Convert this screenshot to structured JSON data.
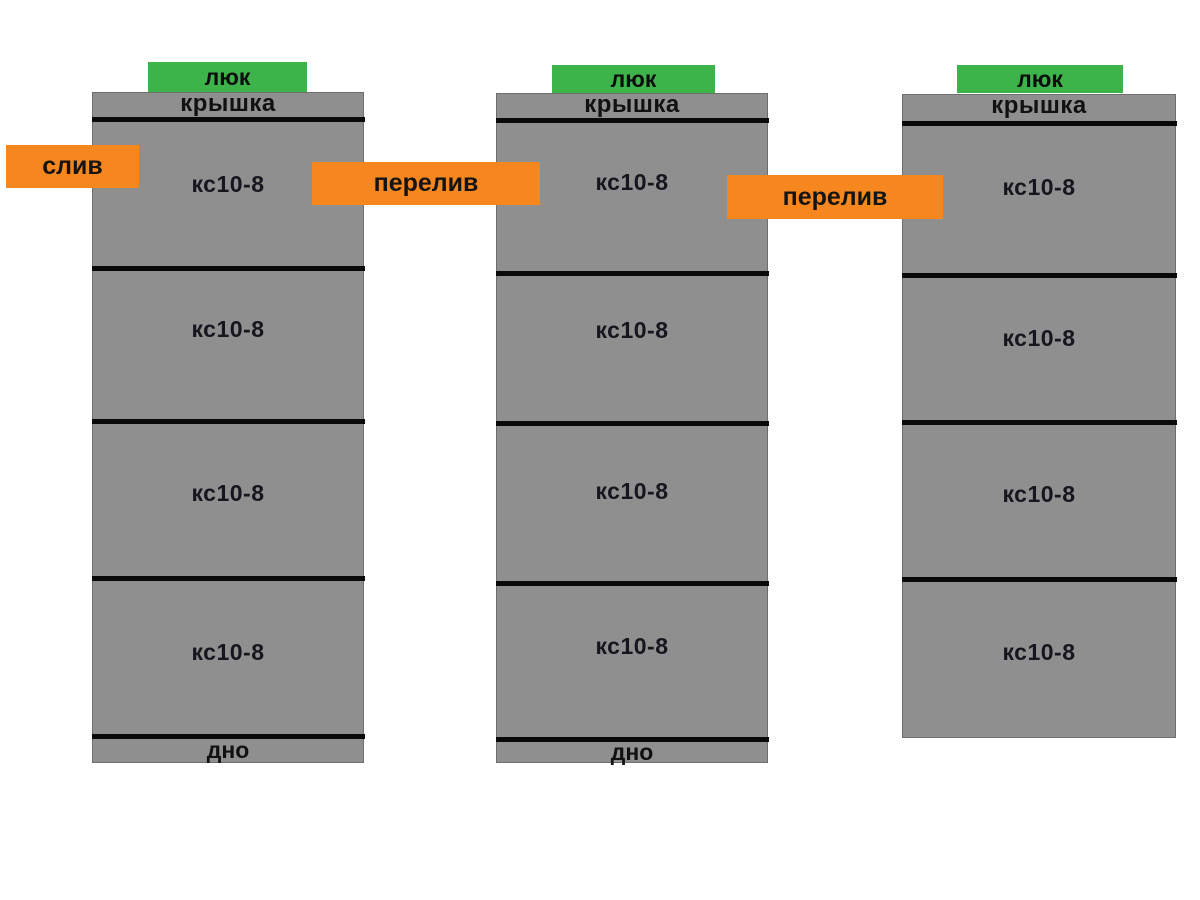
{
  "diagram": {
    "kind": "septic-well-scheme",
    "colors": {
      "background": "#ffffff",
      "tank_gray": "#8f8f8f",
      "joint_line_black": "#0a0a0a",
      "hatch_green": "#3cb44a",
      "pipe_label_orange": "#f6871f",
      "text_dark": "#16161f"
    },
    "tanks": [
      {
        "hatch": "люк",
        "cover": "крышка",
        "rings": [
          "кс10-8",
          "кс10-8",
          "кс10-8",
          "кс10-8"
        ],
        "bottom": "дно"
      },
      {
        "hatch": "люк",
        "cover": "крышка",
        "rings": [
          "кс10-8",
          "кс10-8",
          "кс10-8",
          "кс10-8"
        ],
        "bottom": "дно"
      },
      {
        "hatch": "люк",
        "cover": "крышка",
        "rings": [
          "кс10-8",
          "кс10-8",
          "кс10-8",
          "кс10-8"
        ]
      }
    ],
    "pipes": [
      {
        "label": "слив"
      },
      {
        "label": "перелив"
      },
      {
        "label": "перелив"
      }
    ]
  }
}
